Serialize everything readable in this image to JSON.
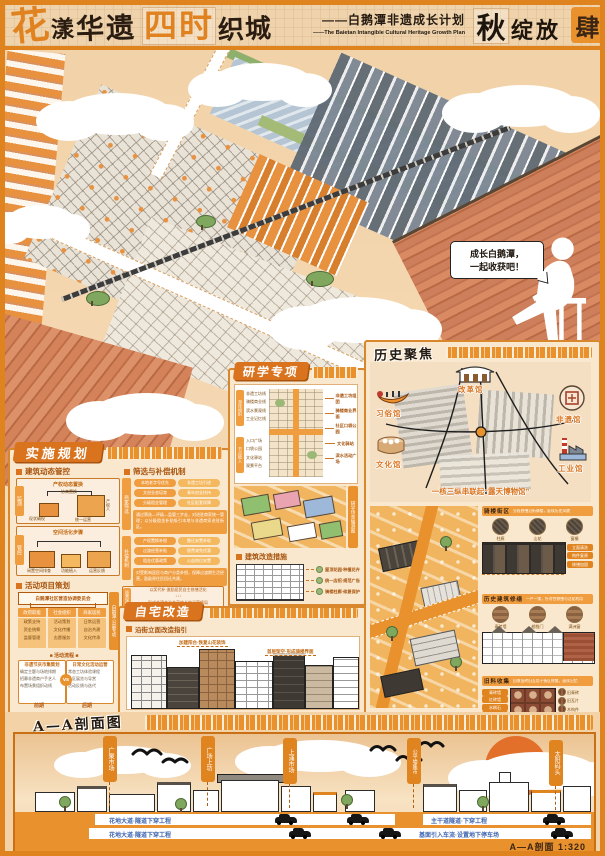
{
  "colors": {
    "accent": "#e0821f",
    "deep_orange": "#d9731d",
    "peach": "#f2d2a6",
    "ink": "#33261a",
    "road_blue": "#3f66b0",
    "river": "#b5c5d3",
    "sun": "#e2702a"
  },
  "header": {
    "title_hua": "花",
    "title_yang": "漾",
    "title_huayi": "华遗",
    "title_sishi": "四时",
    "title_zhicheng": "织城",
    "subtitle_cn": "——白鹅潭非遗成长计划",
    "subtitle_en": "——The Baietan Intangible Cultural Heritage Growth Plan",
    "season_char": "秋",
    "season_suffix": "绽放",
    "sheet_seal": "肆"
  },
  "scene": {
    "bubble_line1": "成长白鹅潭，",
    "bubble_line2": "一起收获吧！"
  },
  "left_panel": {
    "title": "实施规划",
    "sec_control": {
      "heading": "建筑动态管控",
      "box1": {
        "tab": "监测",
        "caption": "产权动态置换",
        "l1": "现状确权",
        "l2": "协商置换",
        "l3": "产权人",
        "l4": "统一运营"
      },
      "box2": {
        "tab": "管控",
        "caption": "空间活化步骤",
        "l1": "闲置空间排查",
        "l2": "功能植入",
        "l3": "运营反馈"
      }
    },
    "sec_filter": {
      "heading": "筛选与补偿机制",
      "groups": [
        {
          "tab": "商家筛选",
          "pills": [
            "本地老字号优先",
            "非遗工坊引进",
            "文创业态培育",
            "青年创业扶持",
            "分级租金管理",
            "社区配套保障"
          ],
          "note": "通过筛选—评级—监管三步走，对进驻商家统一管理；以分级租金补贴吸引本地与非遗商家进驻街区。"
        },
        {
          "tab": "补偿机制",
          "pills": [
            "产权置换补偿",
            "搬迁安置补助",
            "过渡经营补贴",
            "税费减免优惠",
            "租金优惠政策",
            "公益岗位安置"
          ],
          "note": "对受影响居民与商户分类补偿，保障过渡期生活经营，鼓励原住民回迁共建。"
        }
      ],
      "bottom": {
        "tab": "运营保障",
        "lines": "以奖代补·激励居民自主修缮活化\n↓↓↓\n形成共建共治共享的长效运营格局"
      }
    },
    "sec_activity": {
      "heading": "活动项目策划",
      "top_box": "白鹅潭社区营造协调委员会",
      "branches": [
        {
          "head": "政府职能",
          "items": "政策支持\n资金统筹\n监督管理"
        },
        {
          "head": "社会组织",
          "items": "活动策划\n文化传播\n志愿服务"
        },
        {
          "head": "商家居民",
          "items": "日常运营\n自治共建\n文化传承"
        }
      ],
      "divider": "■ 活动流程 ■",
      "compare": {
        "left_title": "非遗节庆市集策划",
        "left_items": "确定主题与场地排期\n招募非遗商户手艺人\n布置场景组织动线",
        "vs": "vs",
        "right_title": "日常文化活动运营",
        "right_items": "常态工坊体验课程\n社区展览与导赏\n活动反馈与迭代",
        "foot_left": "前期",
        "foot_right": "后期"
      },
      "side_tab": "白鹅潭公益专项"
    }
  },
  "mid_panel": {
    "title": "研学专项",
    "group1": {
      "tab": "游径组织",
      "items": "非遗工坊线\n骑楼商业线\n滨水景观线\n工业记忆线"
    },
    "group2": {
      "tab": "节点植入",
      "items": "入口广场\n口袋公园\n文化驿站\n观景平台"
    },
    "plan_labels": [
      "非遗工坊组团",
      "骑楼商业界面",
      "社区口袋公园",
      "文化驿站",
      "滨水活动广场"
    ],
    "axon_tab": "研学场景轴测图",
    "sec_retrofit": {
      "heading": "建筑改造措施",
      "labels": [
        "屋顶花园·种植花卉",
        "统一店招·规范广告",
        "骑楼柱廊·修复保护"
      ]
    }
  },
  "house_panel": {
    "title": "自宅改造",
    "heading": "沿街立面改造指引",
    "callout1": "加建阳台·恢复山花装饰",
    "callout2": "首层架空·形成骑楼界面"
  },
  "right_panel": {
    "title": "历史聚焦",
    "museums": [
      {
        "name": "改革馆"
      },
      {
        "name": "习俗馆"
      },
      {
        "name": "文化馆"
      },
      {
        "name": "非遗馆"
      },
      {
        "name": "工业馆"
      }
    ],
    "caption": "一核三纵串联起“露天博物馆”",
    "sub_panels": [
      {
        "heading": "骑楼街区",
        "note": "分段修缮沿街骑楼，延续历史风貌",
        "circles": [
          "柱廊",
          "山花",
          "窗楣"
        ],
        "tags": [
          "立面清洗",
          "构件复原",
          "修缮加固"
        ]
      },
      {
        "heading": "历史建筑修缮",
        "note": "一户一策，针对性修缮与活化利用",
        "circles": [
          "青砖墙",
          "趟栊门",
          "满洲窗"
        ]
      },
      {
        "heading": "旧料收集",
        "note": "回收旧砖旧瓦用于街区修复，延续记忆",
        "circles": [
          "旧青砖",
          "旧瓦片",
          "木构件"
        ],
        "tags": [
          "青砖墙",
          "红砖墙",
          "水刷石",
          "木门窗"
        ]
      }
    ]
  },
  "section_panel": {
    "title": "A—A剖面图",
    "banners": [
      "广聚市场",
      "广场上坊",
      "上涌市场",
      "公平墟集市",
      "太阳码头"
    ],
    "roads": [
      {
        "text": "花地大道·隧道下穿工程"
      },
      {
        "text": "主干道隧道·下穿工程"
      },
      {
        "text": "花地大道·隧道下穿工程"
      },
      {
        "text": "基面引入车流·设置地下停车场"
      }
    ],
    "scale": "A—A剖面  1:320"
  }
}
